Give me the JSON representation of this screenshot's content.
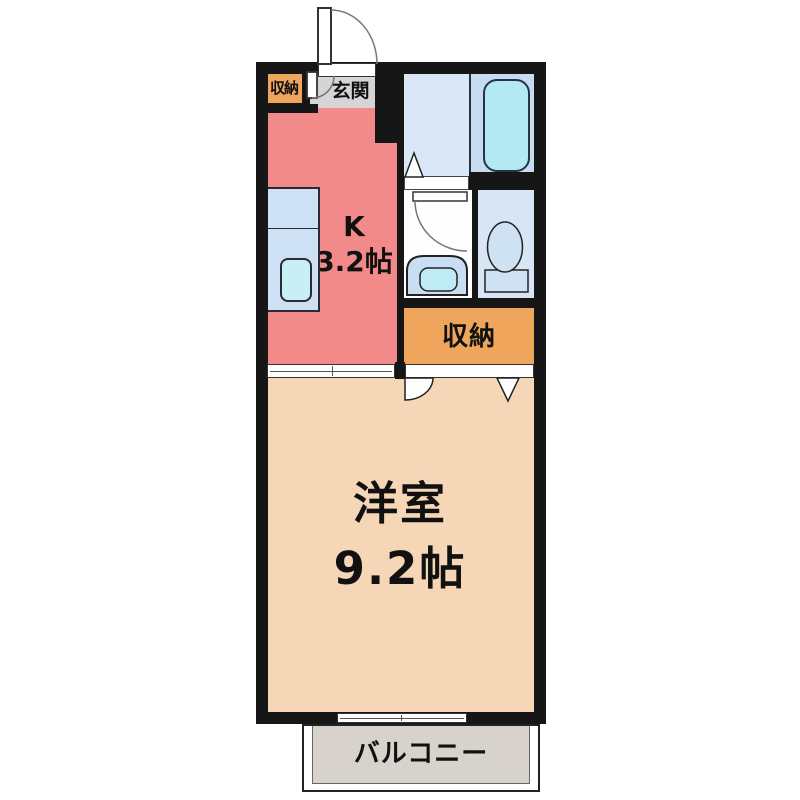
{
  "plan": {
    "type_note": "1K apartment floor plan",
    "rooms": {
      "entrance_closet": {
        "label": "収納"
      },
      "entrance": {
        "label": "玄関"
      },
      "kitchen": {
        "type_label": "K",
        "size_label": "3.2帖"
      },
      "storage": {
        "label": "収納"
      },
      "western_room": {
        "name_label": "洋室",
        "size_label": "9.2帖"
      },
      "balcony": {
        "label": "バルコニー"
      }
    }
  },
  "colors": {
    "wall": "#161616",
    "kitchen": "#F28A8A",
    "main_room": "#F5D6B7",
    "storage": "#EFA55C",
    "entrance_floor": "#D5D5D5",
    "balcony_floor": "#D7D3CC",
    "bath_floor": "#DAE7F7",
    "tub_area": "#C7DCF2",
    "bathtub": "#B2E9F3",
    "kitchen_counter": "#CEE1F4",
    "kitchen_sink": "#C9EFF6",
    "washroom_floor": "#FEFEFE",
    "basin_counter": "#C9DEF2",
    "basin": "#BFEBF5",
    "toilet_room": "#D7E5F5",
    "toilet_fixture": "#CFE2F4",
    "label_text": "#111111"
  }
}
